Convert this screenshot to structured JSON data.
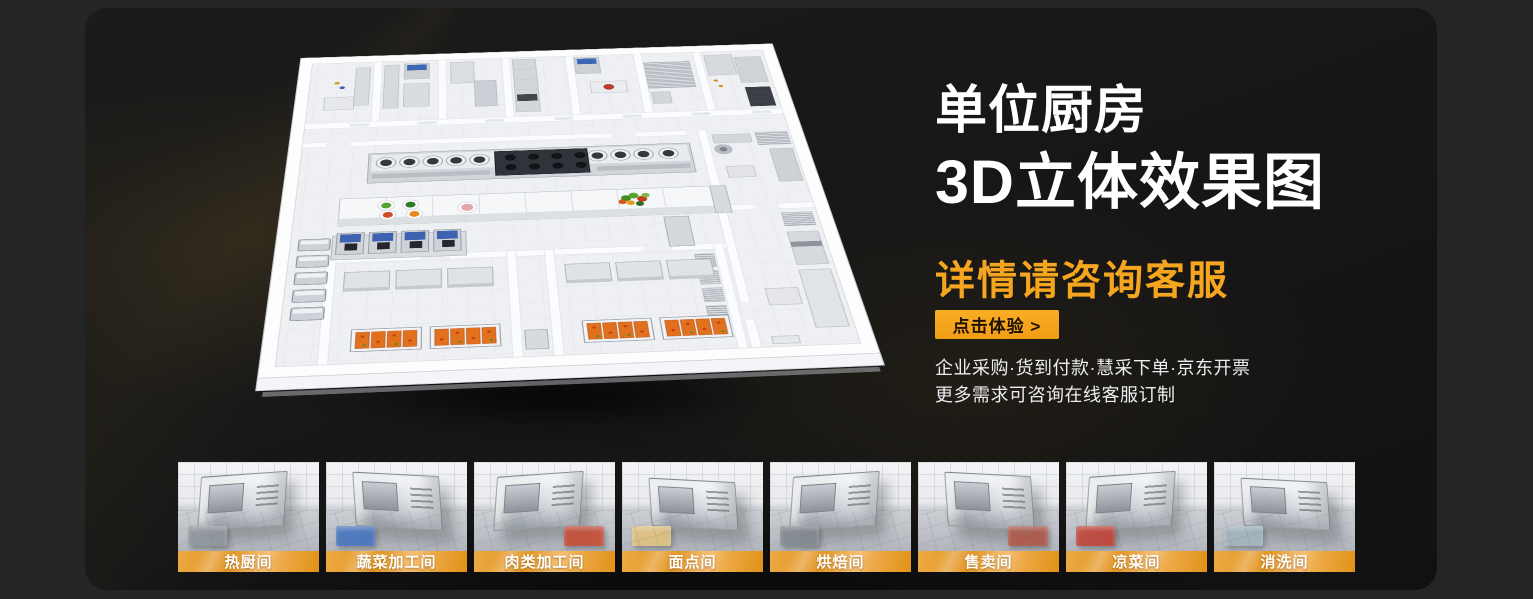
{
  "page": {
    "outer_bg": "#242526",
    "panel_bg": "#161616",
    "accent": "#F6A51E"
  },
  "hero": {
    "title_line1": "单位厨房",
    "title_line2": "3D立体效果图",
    "subtitle": "详情请咨询客服",
    "cta_label": "点击体验 >",
    "desc_line1": "企业采购·货到付款·慧采下单·京东开票",
    "desc_line2": "更多需求可咨询在线客服订制"
  },
  "thumbnails": [
    {
      "label": "热厨间",
      "accent": "#8e949c"
    },
    {
      "label": "蔬菜加工间",
      "accent": "#3f6fbe"
    },
    {
      "label": "肉类加工间",
      "accent": "#c8452c"
    },
    {
      "label": "面点间",
      "accent": "#e3c27a"
    },
    {
      "label": "烘焙间",
      "accent": "#7f858d"
    },
    {
      "label": "售卖间",
      "accent": "#b05340"
    },
    {
      "label": "凉菜间",
      "accent": "#c23b30"
    },
    {
      "label": "消洗间",
      "accent": "#9fb4bc"
    }
  ]
}
